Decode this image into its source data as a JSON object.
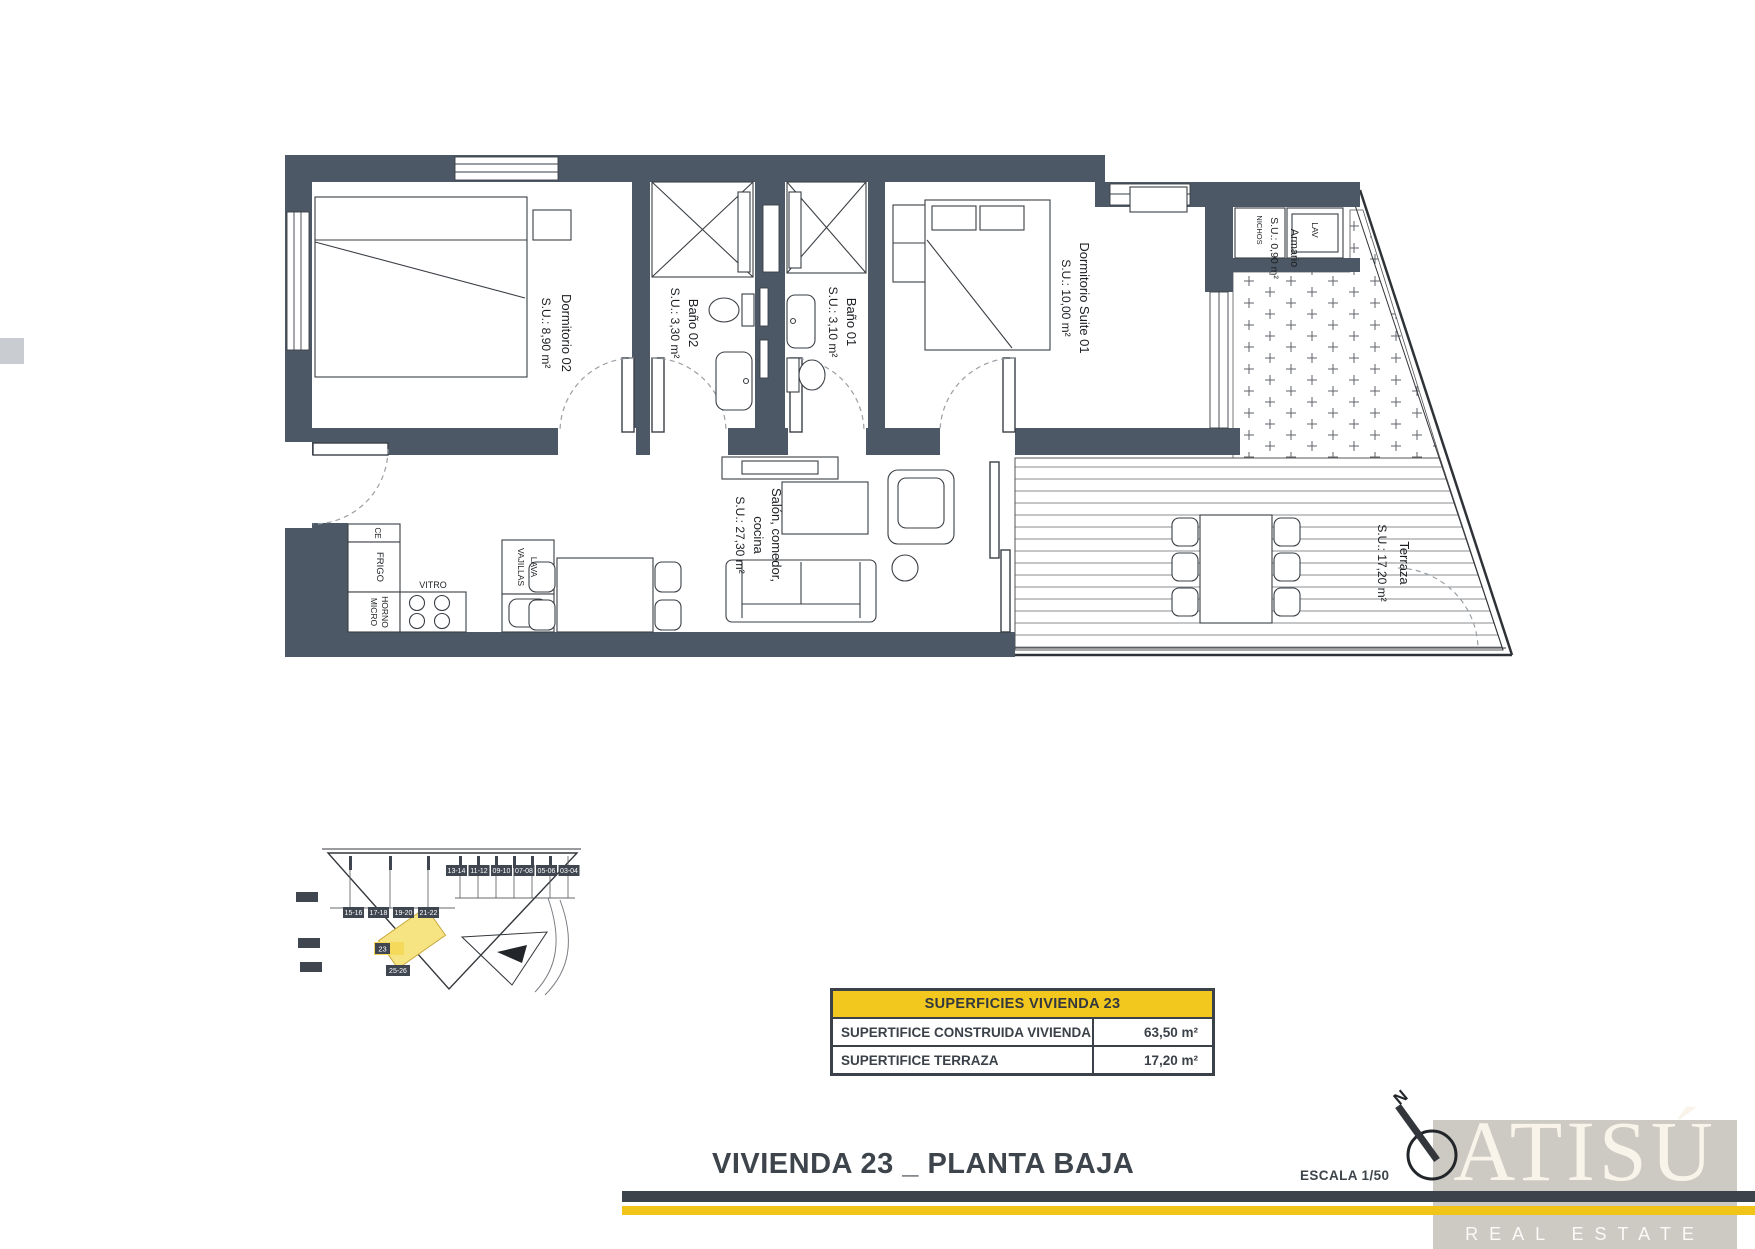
{
  "document": {
    "title": "VIVIENDA 23 _ PLANTA BAJA",
    "scale_label": "ESCALA 1/50"
  },
  "rooms": {
    "dormitorio02": {
      "name": "Dormitorio 02",
      "area": "S.U.: 8,90 m²"
    },
    "bano02": {
      "name": "Baño 02",
      "area": "S.U.: 3,30 m²"
    },
    "bano01": {
      "name": "Baño 01",
      "area": "S.U.: 3,10 m²"
    },
    "suite": {
      "name": "Dormitorio Suite 01",
      "area": "S.U.: 10,00 m²"
    },
    "salon": {
      "name_line1": "Salón, comedor,",
      "name_line2": "cocina",
      "area": "S.U.: 27,30 m²"
    },
    "terraza": {
      "name": "Terraza",
      "area": "S.U.: 17,20 m²"
    },
    "armario": {
      "name": "Armario",
      "area": "S.U.: 0,90 m²"
    }
  },
  "appliances": {
    "ce": "CE",
    "frigo": "FRIGO",
    "horno": "HORNO",
    "micro": "MICRO",
    "vitro": "VITRO",
    "lava": "LAVA",
    "vajillas": "VAJILLAS",
    "lav": "LAV",
    "nichos": "NICHOS"
  },
  "areas_table": {
    "header": "SUPERFICIES VIVIENDA 23",
    "rows": [
      {
        "label": "SUPERTIFICE CONSTRUIDA VIVIENDA",
        "value": "63,50 m²"
      },
      {
        "label": "SUPERTIFICE TERRAZA",
        "value": "17,20 m²"
      }
    ]
  },
  "site_plan": {
    "row1_badges": [
      "13-14",
      "11-12",
      "09-10",
      "07-08",
      "05-06",
      "03-04"
    ],
    "row2_badges": [
      "15-16",
      "17-18",
      "19-20",
      "21-22"
    ],
    "unit_badge": "23",
    "below_badge": "25-26"
  },
  "compass": {
    "label": "N"
  },
  "brand": {
    "name": "ATISÚ",
    "tagline": "REAL ESTATE"
  },
  "colors": {
    "wall": "#4d5866",
    "accent_yellow": "#f2c81e",
    "bar_dark": "#3d434a",
    "logo_background": "#cdc9c3",
    "highlight_unit": "#f6e483"
  }
}
